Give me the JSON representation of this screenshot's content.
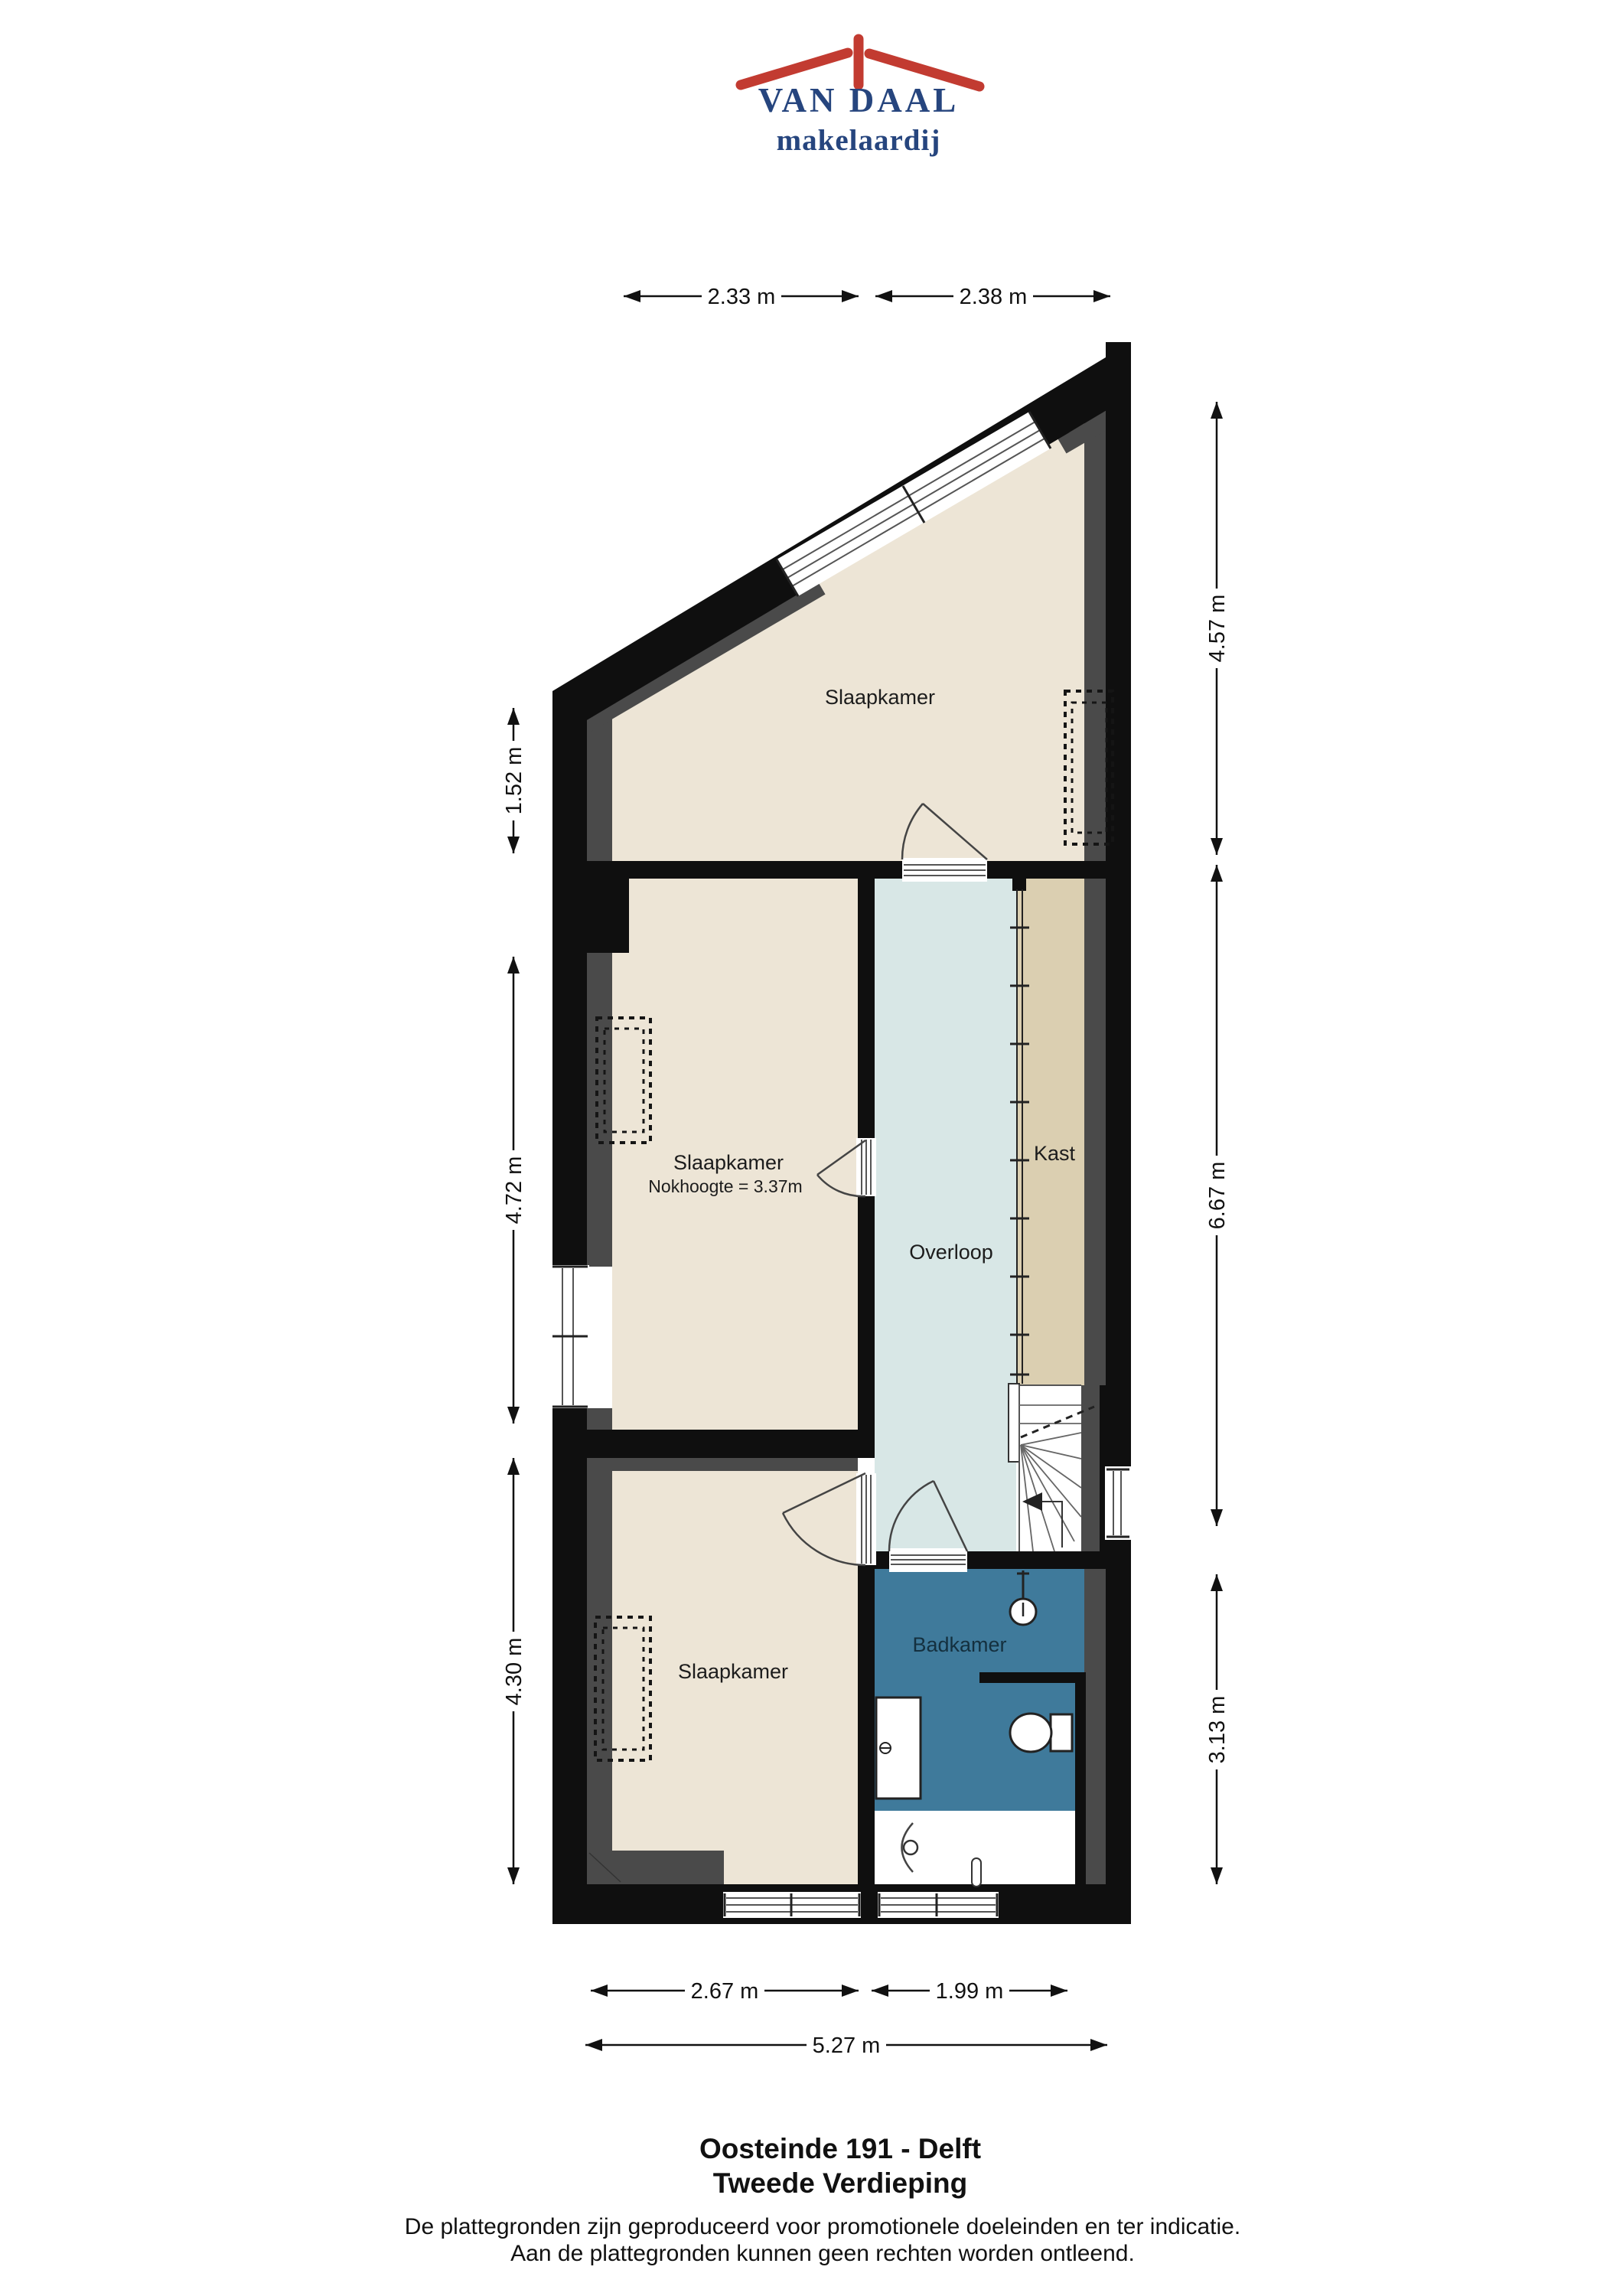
{
  "logo": {
    "name": "VAN DAAL",
    "tagline": "makelaardij",
    "roof_color": "#C23B31",
    "text_color": "#26457E"
  },
  "plan": {
    "rooms": [
      {
        "id": "slaapkamer-top",
        "label": "Slaapkamer"
      },
      {
        "id": "slaapkamer-middle",
        "label": "Slaapkamer",
        "note": "Nokhoogte = 3.37m"
      },
      {
        "id": "overloop",
        "label": "Overloop"
      },
      {
        "id": "kast",
        "label": "Kast"
      },
      {
        "id": "badkamer",
        "label": "Badkamer"
      },
      {
        "id": "slaapkamer-bottom",
        "label": "Slaapkamer"
      }
    ],
    "dims": {
      "top1": "2.33 m",
      "top2": "2.38 m",
      "left1": "1.52 m",
      "left2": "4.72 m",
      "left3": "4.30 m",
      "right1": "4.57 m",
      "right2": "6.67 m",
      "right3": "3.13 m",
      "bottom1": "2.67 m",
      "bottom2": "1.99 m",
      "bottom3": "5.27 m"
    },
    "colors": {
      "wall": "#0F0F0F",
      "wall_lining": "#4A4A4A",
      "floor_bedroom": "#EDE5D6",
      "floor_closet": "#DBCFB1",
      "floor_landing": "#D8E7E6",
      "floor_bathroom": "#3F7A9B"
    }
  },
  "footer": {
    "title": "Oosteinde 191 - Delft",
    "subtitle": "Tweede Verdieping",
    "disclaimer1": "De plattegronden zijn geproduceerd voor promotionele doeleinden en ter indicatie.",
    "disclaimer2": "Aan de plattegronden kunnen geen rechten worden ontleend."
  }
}
